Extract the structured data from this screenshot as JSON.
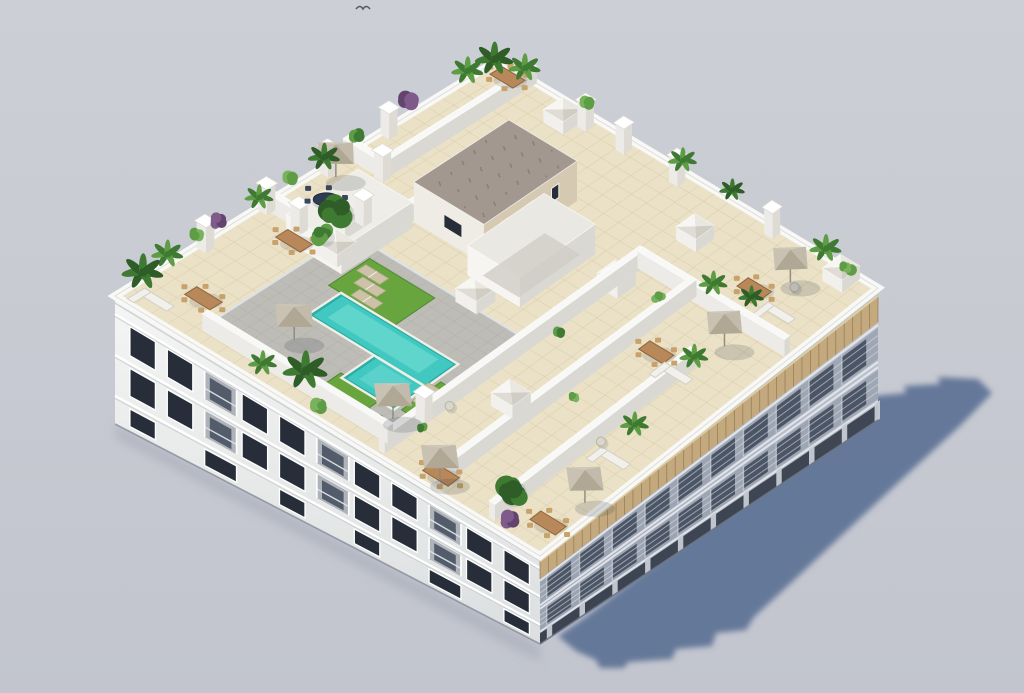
{
  "scene": {
    "type": "3d-architectural-render",
    "view": "aerial-isometric",
    "subject": "white residential apartment block with landscaped rooftop pool terrace",
    "elements": [
      "rooftop-pool",
      "sun-deck",
      "turf-lawns",
      "private-terraces",
      "pyramid-skylights",
      "stair-core",
      "parasols",
      "pergola",
      "palm-trees",
      "purple-shrubs",
      "balcony-facades",
      "cast-shadow",
      "flying-bird"
    ]
  },
  "inventory": {
    "pools": 1,
    "parasols": 7,
    "pyramid_skylights": 8,
    "dining_tables": 8,
    "sofa_groups": 4,
    "sun_loungers": 5,
    "round_tables": 3,
    "chimney_pillars": 12,
    "plants": 32,
    "visible_floors": 3
  },
  "palette": {
    "background_top": "#cdcfd6",
    "background_bottom": "#c2c5ce",
    "shadow": "#5d7294",
    "contact_shadow": "#8f96a4",
    "facade_white": "#f4f5f4",
    "facade_white_low": "#dcdfe0",
    "facade_shade_top": "#c3c9d3",
    "facade_shade_low": "#9ba3b1",
    "window_dark": "#272e3a",
    "balcony_void": "#434c5c",
    "railing_glass": "#dde3ea",
    "parapet": "#f8f8f6",
    "parapet_shade": "#d9d8d2",
    "tile": "#ebe1c6",
    "tile_line": "#d6c9a6",
    "deck": "#bdbcb6",
    "deck_line": "#a8a7a1",
    "pool": "#41c9c1",
    "pool_light": "#79ded6",
    "pool_deep": "#29aea7",
    "coping": "#f1eee5",
    "turf": "#68a53e",
    "turf_dark": "#4e8a2e",
    "hedge": "#3c642c",
    "hedge_dark": "#2f5323",
    "wood": "#b9885a",
    "wood_dark": "#8f6537",
    "navy_table": "#2f3d52",
    "pergola": "#c3a97d",
    "pergola_line": "#8f7550",
    "core_wall": "#d5c9b2",
    "core_wall_shade": "#bfb29a",
    "gravel": "#a39890",
    "gravel_dot": "#897e76",
    "plant_green": "#3f7a33",
    "plant_green_light": "#5e9c46",
    "plant_dark": "#2e5d27",
    "plant_purple": "#7e5b8a",
    "plant_purple_dark": "#65436f",
    "parasol": "#cfc8b9",
    "parasol_shade": "#b0a795",
    "white_furniture": "#f1f0ea",
    "furniture_shade": "#d3d0c6",
    "lounger": "#cdc2a7",
    "chimney": "#f5f5f2",
    "chimney_shade": "#dddbd4",
    "skylight_nw": "#f7f6f2",
    "skylight_ne": "#e9e7e0",
    "skylight_se": "#cfcdc4",
    "skylight_sw": "#dedcd4",
    "bird": "#565b63"
  }
}
